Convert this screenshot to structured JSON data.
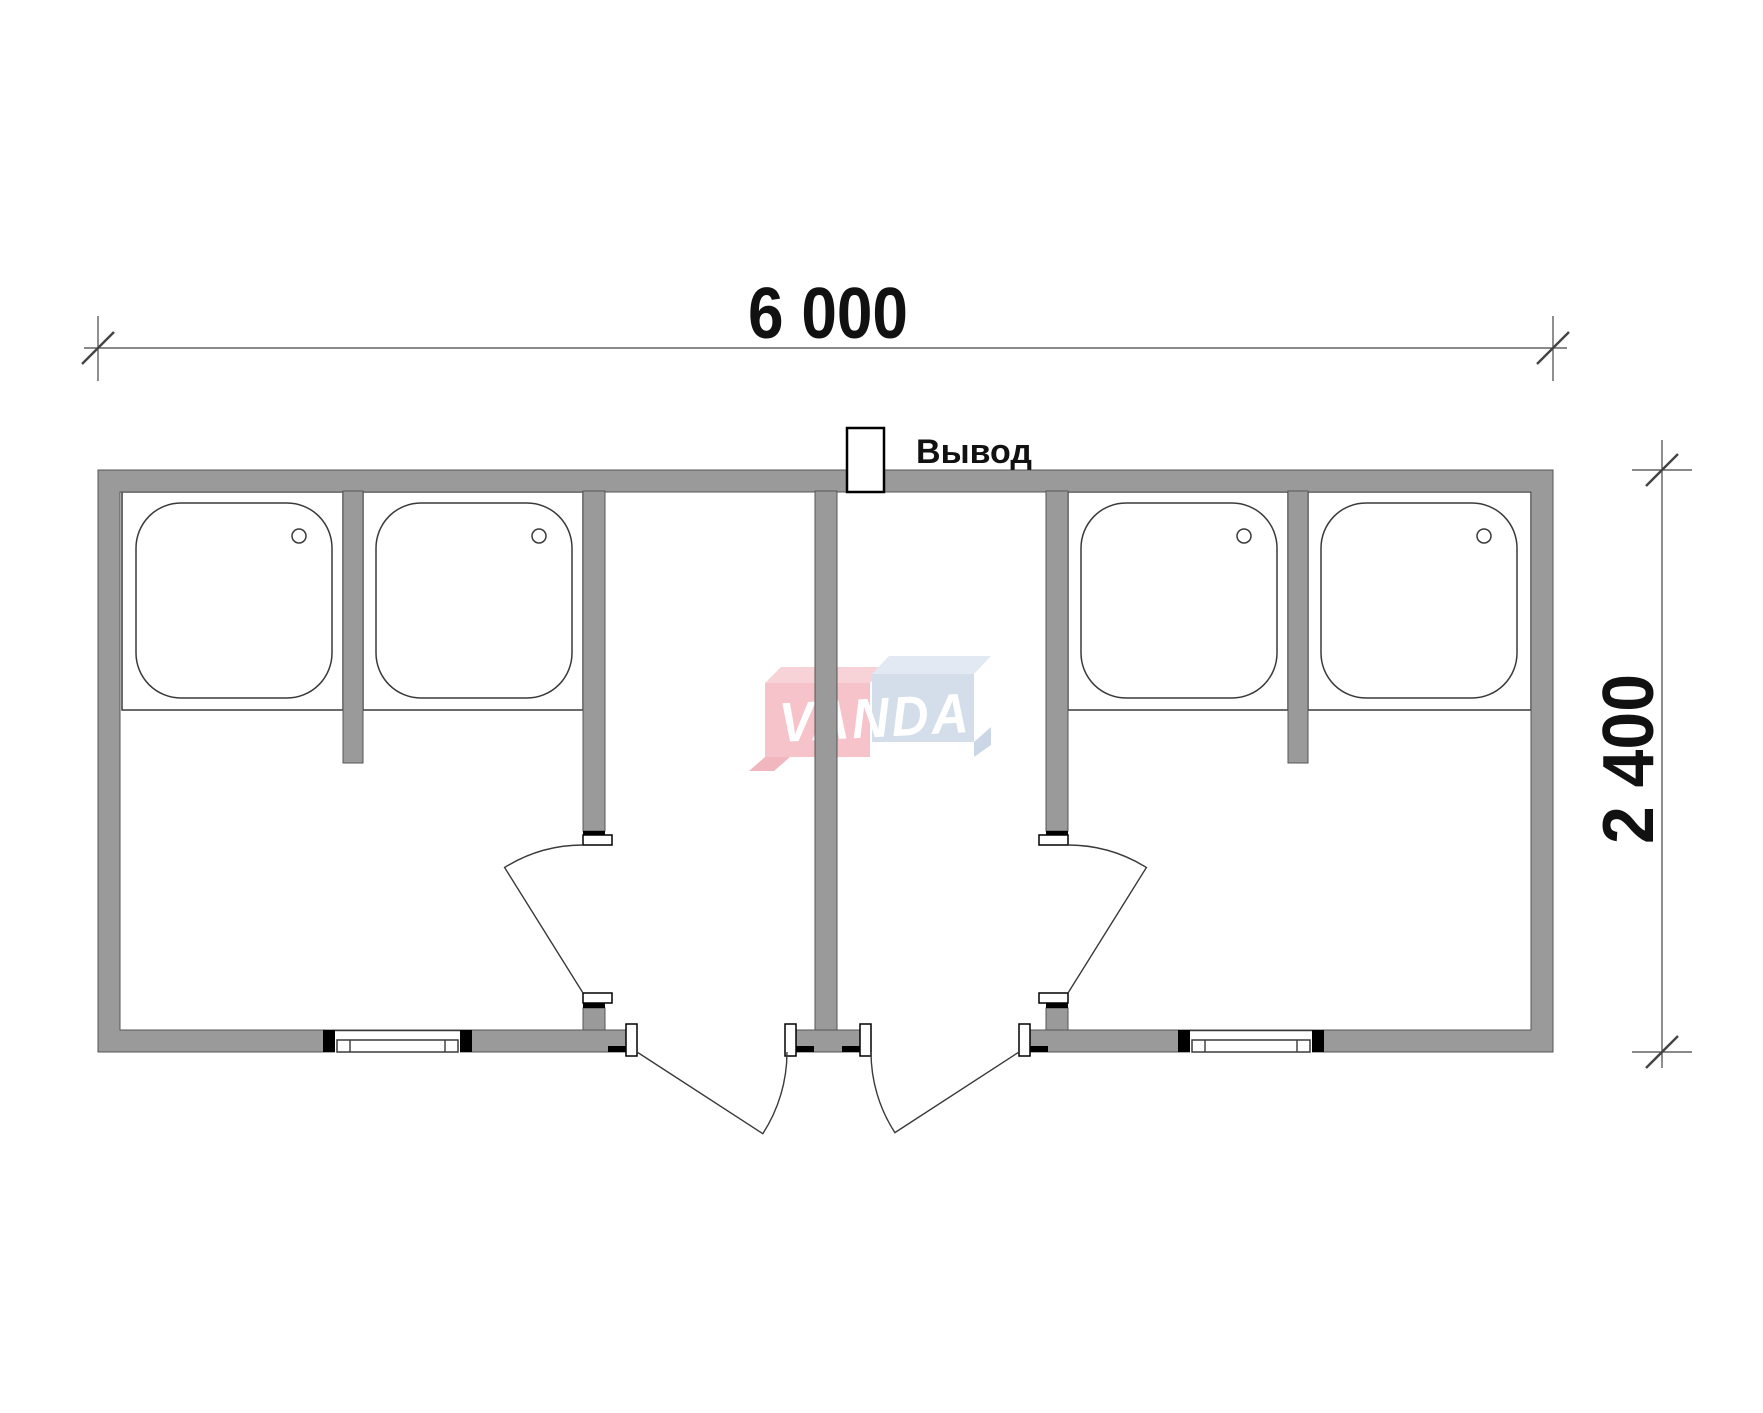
{
  "page": {
    "background": "#ffffff"
  },
  "dimensions": {
    "width_label": "6 000",
    "height_label": "2 400"
  },
  "outlet": {
    "label": "Вывод"
  },
  "watermark": {
    "text": "VANDA"
  },
  "colors": {
    "wall": "#9a9a9a",
    "wall_outline": "#555555",
    "drawing_line": "#3a3a3a",
    "jamb_black": "#000000",
    "watermark_red_front": "#f4b9c0",
    "watermark_red_top": "#f6ccd1",
    "watermark_red_side": "#efaab3",
    "watermark_blue_front": "#cdd9e8",
    "watermark_blue_top": "#dde6f1",
    "watermark_blue_side": "#c2d1e3",
    "watermark_text": "#ffffff"
  },
  "plan": {
    "shower_trays": 4,
    "shower_drains": 4,
    "windows": 2,
    "exterior_doors": 2,
    "interior_doors": 2,
    "outlet_stubs": 1
  }
}
